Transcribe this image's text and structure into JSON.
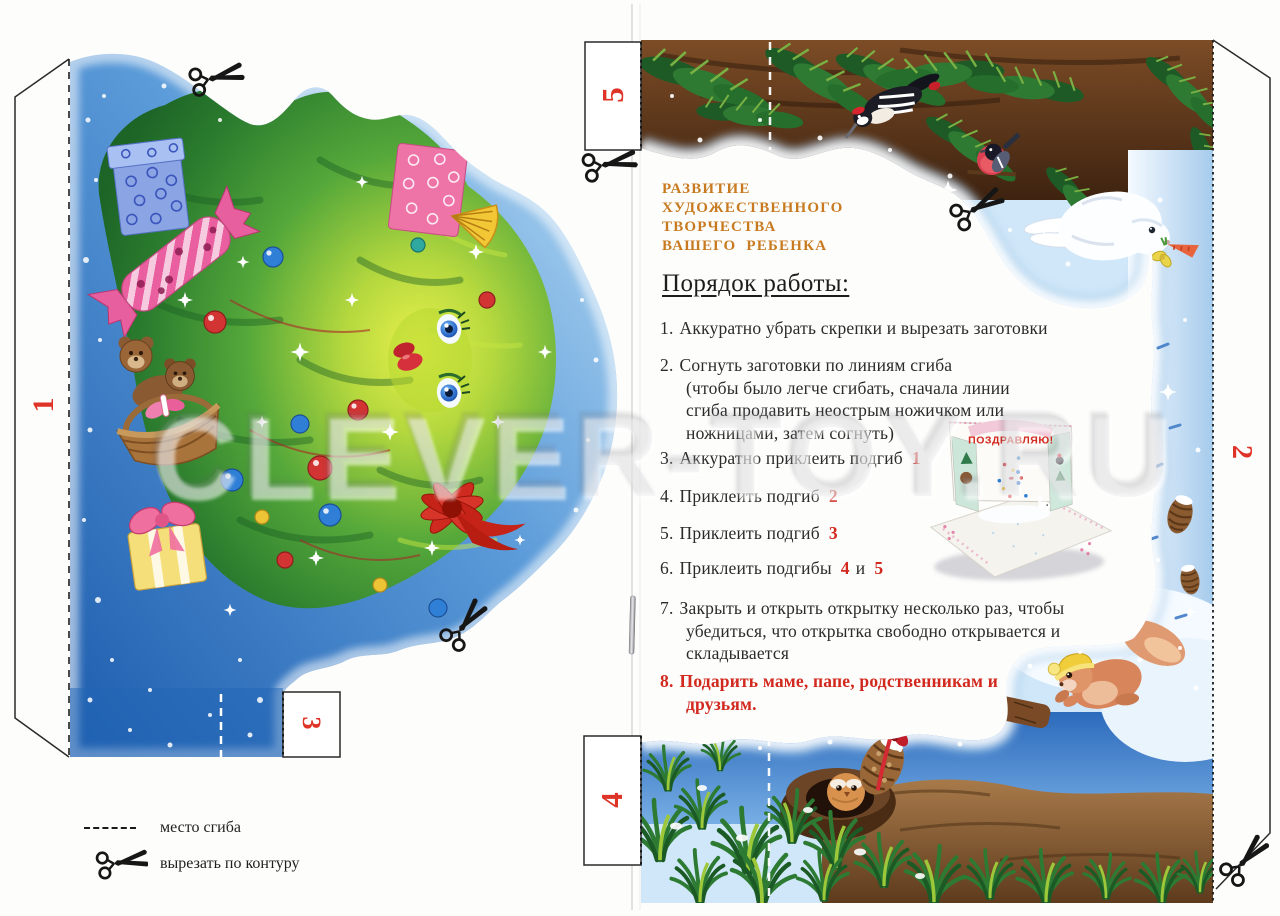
{
  "page": {
    "watermark": "CLEVER-TOY.RU",
    "colors": {
      "accent_orange": "#c87a20",
      "accent_red": "#d2281e",
      "tab_red": "#de3326",
      "text_black": "#2b2b2b",
      "illustration_blue": "#3e7fca",
      "illustration_green": "#3c9238"
    },
    "left_sheet": {
      "tab_1": "1",
      "tab_3": "3",
      "legend": {
        "fold_label": "место сгиба",
        "cut_label": "вырезать по контуру"
      }
    },
    "right_sheet": {
      "tab_5": "5",
      "tab_4": "4",
      "tab_2": "2",
      "header_lines": [
        "РАЗВИТИЕ",
        "ХУДОЖЕСТВЕННОГО",
        "ТВОРЧЕСТВА",
        "ВАШЕГО РЕБЕНКА"
      ],
      "section_title": "Порядок работы:",
      "steps": [
        {
          "num": "1.",
          "text": "Аккуратно убрать скрепки и вырезать заготовки"
        },
        {
          "num": "2.",
          "text": "Согнуть заготовки по линиям сгиба",
          "note": "(чтобы было легче сгибать, сначала линии сгиба продавить неострым ножичком или ножницами, затем согнуть)"
        },
        {
          "num": "3.",
          "text": "Аккуратно приклеить подгиб",
          "ref1": "1"
        },
        {
          "num": "4.",
          "text": "Приклеить подгиб",
          "ref1": "2"
        },
        {
          "num": "5.",
          "text": "Приклеить подгиб",
          "ref1": "3"
        },
        {
          "num": "6.",
          "text": "Приклеить подгибы",
          "ref1": "4",
          "mid": "и",
          "ref2": "5"
        },
        {
          "num": "7.",
          "text": "Закрыть и открыть открытку несколько раз, чтобы убедиться, что открытка свободно открывается и складывается"
        },
        {
          "num": "8.",
          "text": "Подарить маме, папе, родственникам и друзьям."
        }
      ],
      "finished_card_caption": "ПОЗДРАВЛЯЮ!"
    }
  }
}
